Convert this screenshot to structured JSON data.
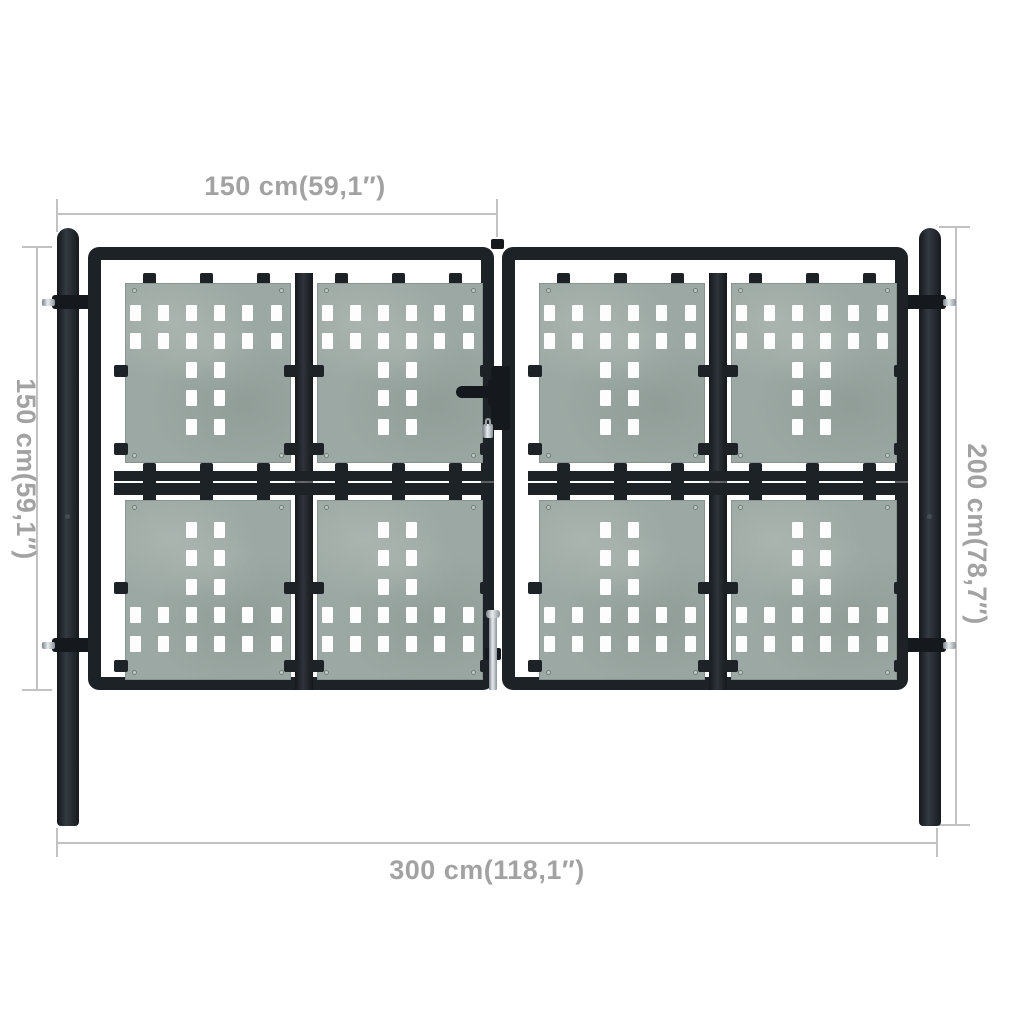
{
  "title": "Black double door garden gate with dimension annotations",
  "colors": {
    "background": "#ffffff",
    "frame_black": "#1d2227",
    "panel_green_gray": "#9ca8a3",
    "hole_white": "#fdfdfd",
    "dimension_line": "#c2c2c2",
    "dimension_text": "#a2a2a2",
    "bolt_silver": "#d7dcdf"
  },
  "dimensions": {
    "top_label": "150 cm(59,1″)",
    "left_label": "150 cm(59,1″)",
    "right_label": "200 cm(78,7″)",
    "bottom_label": "300 cm(118,1″)"
  },
  "gate": {
    "leaves": 2,
    "panels_per_leaf": 4,
    "hole_grid": {
      "cols": 6,
      "rows": 5,
      "hole_w": 11,
      "hole_h": 16,
      "col_pitch": 28.2,
      "row_pitch": 28.6
    },
    "upper_panel_full_rows": [
      0,
      1
    ],
    "lower_panel_full_rows": [
      3,
      4
    ],
    "narrow_cols": [
      2,
      3
    ],
    "tab_centers": [
      48,
      105,
      162,
      240,
      297,
      354
    ],
    "panel_positions": [
      {
        "x": 24,
        "y": 23,
        "type": "upper"
      },
      {
        "x": 216,
        "y": 23,
        "type": "upper"
      },
      {
        "x": 24,
        "y": 240,
        "type": "lower"
      },
      {
        "x": 216,
        "y": 240,
        "type": "lower"
      }
    ]
  }
}
